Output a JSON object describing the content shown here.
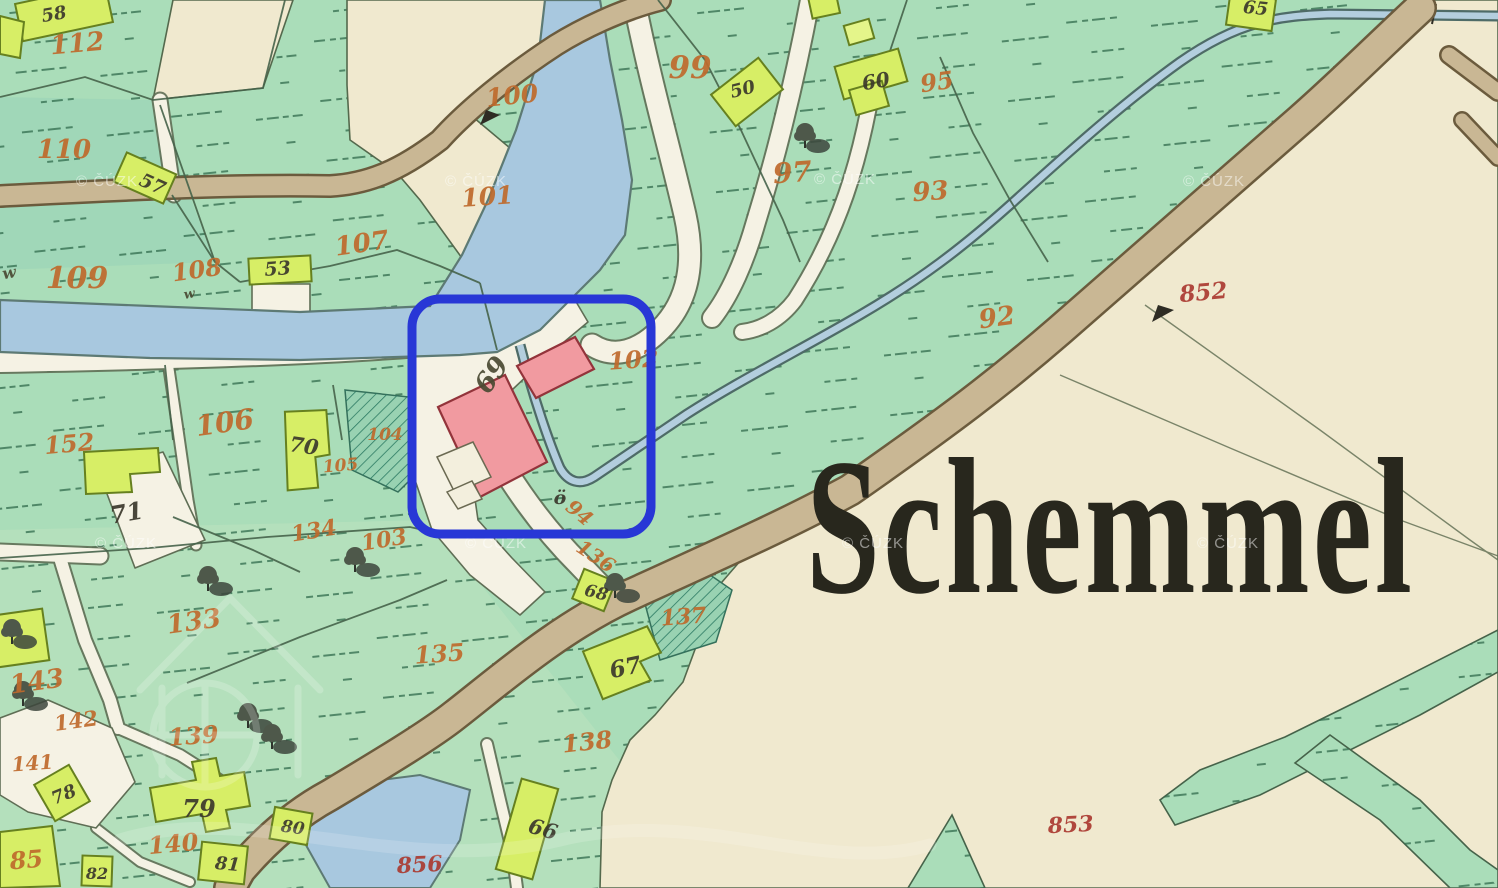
{
  "map": {
    "place_label": "Schemmel",
    "map_style": "historic-cadastral-map",
    "highlight": {
      "color": "#2837d6",
      "shape": "rounded-rectangle"
    },
    "watermarks": {
      "text": "© ČÚZK",
      "positions": [
        [
          76,
          186
        ],
        [
          445,
          186
        ],
        [
          814,
          184
        ],
        [
          1183,
          186
        ],
        [
          95,
          548
        ],
        [
          465,
          548
        ],
        [
          842,
          548
        ],
        [
          1197,
          548
        ]
      ]
    },
    "palette": {
      "meadow_green": "#aaddb9",
      "cream": "#f0e9cf",
      "water_blue": "#a8c8df",
      "road_tan": "#c9b794",
      "path_white": "#f5f2e4",
      "building_wood_yellow": "#d7ee66",
      "building_masonry_pink": "#f19aa0",
      "number_orange": "#bf6a2c",
      "number_red": "#ab3a31",
      "number_black": "#3b382c"
    },
    "parcel_labels": [
      {
        "text": "58",
        "x": 55,
        "y": 20,
        "rot": -10,
        "color": "bk",
        "size": 18
      },
      {
        "text": "112",
        "x": 78,
        "y": 52,
        "rot": -5,
        "color": "or",
        "size": 26
      },
      {
        "text": "110",
        "x": 64,
        "y": 158,
        "rot": 0,
        "color": "or",
        "size": 26
      },
      {
        "text": "57",
        "x": 150,
        "y": 190,
        "rot": 24,
        "color": "bk",
        "size": 19
      },
      {
        "text": "109",
        "x": 77,
        "y": 288,
        "rot": 0,
        "color": "or",
        "size": 30
      },
      {
        "text": "108",
        "x": 198,
        "y": 278,
        "rot": -8,
        "color": "or",
        "size": 24
      },
      {
        "text": "53",
        "x": 278,
        "y": 275,
        "rot": -4,
        "color": "bk",
        "size": 19
      },
      {
        "text": "107",
        "x": 363,
        "y": 252,
        "rot": -8,
        "color": "or",
        "size": 26
      },
      {
        "text": "100",
        "x": 513,
        "y": 104,
        "rot": -6,
        "color": "or",
        "size": 25
      },
      {
        "text": "101",
        "x": 488,
        "y": 205,
        "rot": -4,
        "color": "or",
        "size": 25
      },
      {
        "text": "99",
        "x": 690,
        "y": 78,
        "rot": 0,
        "color": "or",
        "size": 31
      },
      {
        "text": "50",
        "x": 744,
        "y": 95,
        "rot": -14,
        "color": "bk",
        "size": 18
      },
      {
        "text": "60",
        "x": 877,
        "y": 88,
        "rot": -10,
        "color": "bk",
        "size": 20
      },
      {
        "text": "95",
        "x": 938,
        "y": 90,
        "rot": -8,
        "color": "or",
        "size": 24
      },
      {
        "text": "97",
        "x": 793,
        "y": 182,
        "rot": -4,
        "color": "or",
        "size": 28
      },
      {
        "text": "93",
        "x": 931,
        "y": 200,
        "rot": -4,
        "color": "or",
        "size": 26
      },
      {
        "text": "65",
        "x": 1255,
        "y": 14,
        "rot": 6,
        "color": "bk",
        "size": 18
      },
      {
        "text": "92",
        "x": 998,
        "y": 326,
        "rot": -8,
        "color": "or",
        "size": 26
      },
      {
        "text": "852",
        "x": 1204,
        "y": 300,
        "rot": -5,
        "color": "rd",
        "size": 23
      },
      {
        "text": "152",
        "x": 70,
        "y": 452,
        "rot": -5,
        "color": "or",
        "size": 24
      },
      {
        "text": "106",
        "x": 226,
        "y": 432,
        "rot": -8,
        "color": "or",
        "size": 28
      },
      {
        "text": "70",
        "x": 303,
        "y": 453,
        "rot": 8,
        "color": "bk",
        "size": 21
      },
      {
        "text": "105",
        "x": 341,
        "y": 471,
        "rot": -5,
        "color": "or",
        "size": 17
      },
      {
        "text": "104",
        "x": 385,
        "y": 440,
        "rot": 0,
        "color": "or",
        "size": 17
      },
      {
        "text": "71",
        "x": 128,
        "y": 521,
        "rot": -10,
        "color": "bk",
        "size": 24
      },
      {
        "text": "134",
        "x": 315,
        "y": 538,
        "rot": -9,
        "color": "or",
        "size": 22
      },
      {
        "text": "103",
        "x": 385,
        "y": 547,
        "rot": -9,
        "color": "or",
        "size": 22
      },
      {
        "text": "69",
        "x": 499,
        "y": 380,
        "rot": -55,
        "color": "sc",
        "size": 27
      },
      {
        "text": "102",
        "x": 634,
        "y": 368,
        "rot": -4,
        "color": "or",
        "size": 24
      },
      {
        "text": "ö",
        "x": 560,
        "y": 504,
        "rot": 0,
        "color": "bk",
        "size": 19
      },
      {
        "text": "94",
        "x": 575,
        "y": 518,
        "rot": 40,
        "color": "or",
        "size": 20
      },
      {
        "text": "136",
        "x": 592,
        "y": 562,
        "rot": 34,
        "color": "or",
        "size": 20
      },
      {
        "text": "137",
        "x": 684,
        "y": 624,
        "rot": -4,
        "color": "or",
        "size": 22
      },
      {
        "text": "68",
        "x": 595,
        "y": 598,
        "rot": 14,
        "color": "bk",
        "size": 17
      },
      {
        "text": "67",
        "x": 627,
        "y": 675,
        "rot": -12,
        "color": "bk",
        "size": 23
      },
      {
        "text": "135",
        "x": 440,
        "y": 662,
        "rot": -4,
        "color": "or",
        "size": 24
      },
      {
        "text": "138",
        "x": 588,
        "y": 750,
        "rot": -6,
        "color": "or",
        "size": 24
      },
      {
        "text": "66",
        "x": 541,
        "y": 836,
        "rot": 16,
        "color": "bk",
        "size": 21
      },
      {
        "text": "133",
        "x": 195,
        "y": 630,
        "rot": -8,
        "color": "or",
        "size": 26
      },
      {
        "text": "143",
        "x": 38,
        "y": 690,
        "rot": -8,
        "color": "or",
        "size": 26
      },
      {
        "text": "142",
        "x": 77,
        "y": 728,
        "rot": -8,
        "color": "or",
        "size": 21
      },
      {
        "text": "139",
        "x": 194,
        "y": 744,
        "rot": -4,
        "color": "or",
        "size": 24
      },
      {
        "text": "141",
        "x": 33,
        "y": 770,
        "rot": -4,
        "color": "or",
        "size": 20
      },
      {
        "text": "78",
        "x": 66,
        "y": 800,
        "rot": -22,
        "color": "bk",
        "size": 18
      },
      {
        "text": "79",
        "x": 199,
        "y": 817,
        "rot": 0,
        "color": "bk",
        "size": 24
      },
      {
        "text": "140",
        "x": 174,
        "y": 852,
        "rot": -5,
        "color": "or",
        "size": 24
      },
      {
        "text": "80",
        "x": 292,
        "y": 833,
        "rot": 8,
        "color": "bk",
        "size": 17
      },
      {
        "text": "81",
        "x": 227,
        "y": 870,
        "rot": 5,
        "color": "bk",
        "size": 18
      },
      {
        "text": "82",
        "x": 97,
        "y": 879,
        "rot": 0,
        "color": "bk",
        "size": 16
      },
      {
        "text": "85",
        "x": 27,
        "y": 868,
        "rot": -5,
        "color": "or",
        "size": 24
      },
      {
        "text": "856",
        "x": 420,
        "y": 872,
        "rot": -3,
        "color": "rd",
        "size": 22
      },
      {
        "text": "853",
        "x": 1071,
        "y": 832,
        "rot": -3,
        "color": "rd",
        "size": 22
      },
      {
        "text": "w",
        "x": 10,
        "y": 278,
        "rot": -10,
        "color": "sc",
        "size": 16
      },
      {
        "text": "w",
        "x": 190,
        "y": 298,
        "rot": -10,
        "color": "sc",
        "size": 13
      }
    ],
    "symbols": [
      {
        "name": "survey-flag-icon",
        "x": 493,
        "y": 117
      },
      {
        "name": "survey-flag-icon",
        "x": 1163,
        "y": 314
      },
      {
        "name": "bridge-icon",
        "x": 1420,
        "y": 14
      },
      {
        "name": "tree-icon",
        "x": 805,
        "y": 132
      },
      {
        "name": "tree-icon",
        "x": 615,
        "y": 582
      },
      {
        "name": "tree-icon",
        "x": 208,
        "y": 575
      },
      {
        "name": "tree-icon",
        "x": 355,
        "y": 556
      },
      {
        "name": "tree-icon",
        "x": 248,
        "y": 712
      },
      {
        "name": "tree-icon",
        "x": 272,
        "y": 733
      },
      {
        "name": "tree-icon",
        "x": 23,
        "y": 690
      },
      {
        "name": "tree-icon",
        "x": 12,
        "y": 628
      }
    ]
  }
}
